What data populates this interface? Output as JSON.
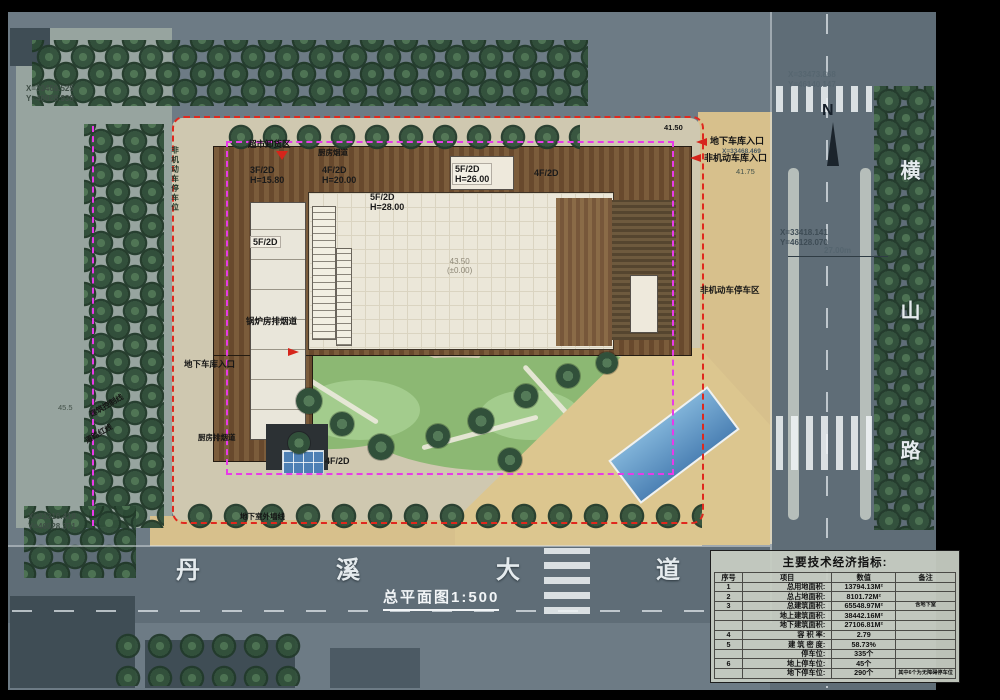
{
  "plan": {
    "title": "总平面图1:500"
  },
  "compass": {
    "label": "N"
  },
  "roads": {
    "bottom": "丹溪大道",
    "right": "横山路"
  },
  "colors": {
    "site_boundary_red": "#e0281e",
    "control_line_magenta": "#e83ae8",
    "pool_blue": "#4d82b5"
  },
  "coords": {
    "top_left_x": "X=33466.525",
    "top_left_y": "Y=46028.938",
    "bottom_left_x": "X=33316.418",
    "bottom_left_y": "Y=46028.371",
    "top_right_x": "X=33473.868",
    "top_right_y": "Y=46140.147",
    "right_x": "X=33418.141",
    "right_y": "Y=46128.070",
    "right_dim": "27.00m",
    "entrance_x": "X=33468.469"
  },
  "elevations": {
    "top_right": "41.50",
    "entrance": "41.75",
    "left": "45.5",
    "center": "43.50",
    "center_zero": "(±0.00)"
  },
  "annotations": {
    "unloading": "超市卸货区",
    "kitchen_flue": "厨房烟道",
    "boiler_flue": "锅炉房排烟道",
    "kitchen_exhaust": "厨房排烟道",
    "garage_entry_left": "地下车库入口",
    "garage_entry_right": "地下车库入口",
    "bike_entry_right": "非机动车库入口",
    "bike_parking_right": "非机动车停车区",
    "bike_parking_left": "非机动车停车位",
    "basement_wall": "地下室外墙线",
    "control_line": "建筑控制线",
    "road_red_line": "道路红线"
  },
  "buildings": [
    {
      "label": "3F/2D",
      "height": "H=15.80"
    },
    {
      "label": "4F/2D",
      "height": "H=20.00"
    },
    {
      "label": "5F/2D",
      "height": "H=26.00"
    },
    {
      "label": "4F/2D",
      "height": ""
    },
    {
      "label": "5F/2D",
      "height": "H=28.00"
    },
    {
      "label": "5F/2D",
      "height": ""
    },
    {
      "label": "4F/2D",
      "height": ""
    }
  ],
  "table": {
    "title": "主要技术经济指标:",
    "headers": [
      "序号",
      "项目",
      "数值",
      "备注"
    ],
    "rows": [
      [
        "1",
        "总用地面积:",
        "13794.13M²",
        ""
      ],
      [
        "2",
        "总占地面积:",
        "8101.72M²",
        ""
      ],
      [
        "3",
        "总建筑面积:",
        "65548.97M²",
        "含地下室"
      ],
      [
        "",
        "地上建筑面积:",
        "38442.16M²",
        ""
      ],
      [
        "",
        "地下建筑面积:",
        "27106.81M²",
        ""
      ],
      [
        "4",
        "容 积 率:",
        "2.79",
        ""
      ],
      [
        "5",
        "建 筑 密 度:",
        "58.73%",
        ""
      ],
      [
        "",
        "停车位:",
        "335个",
        ""
      ],
      [
        "6",
        "地上停车位:",
        "45个",
        ""
      ],
      [
        "",
        "地下停车位:",
        "290个",
        "其中6个为无障碍停车位"
      ]
    ]
  }
}
